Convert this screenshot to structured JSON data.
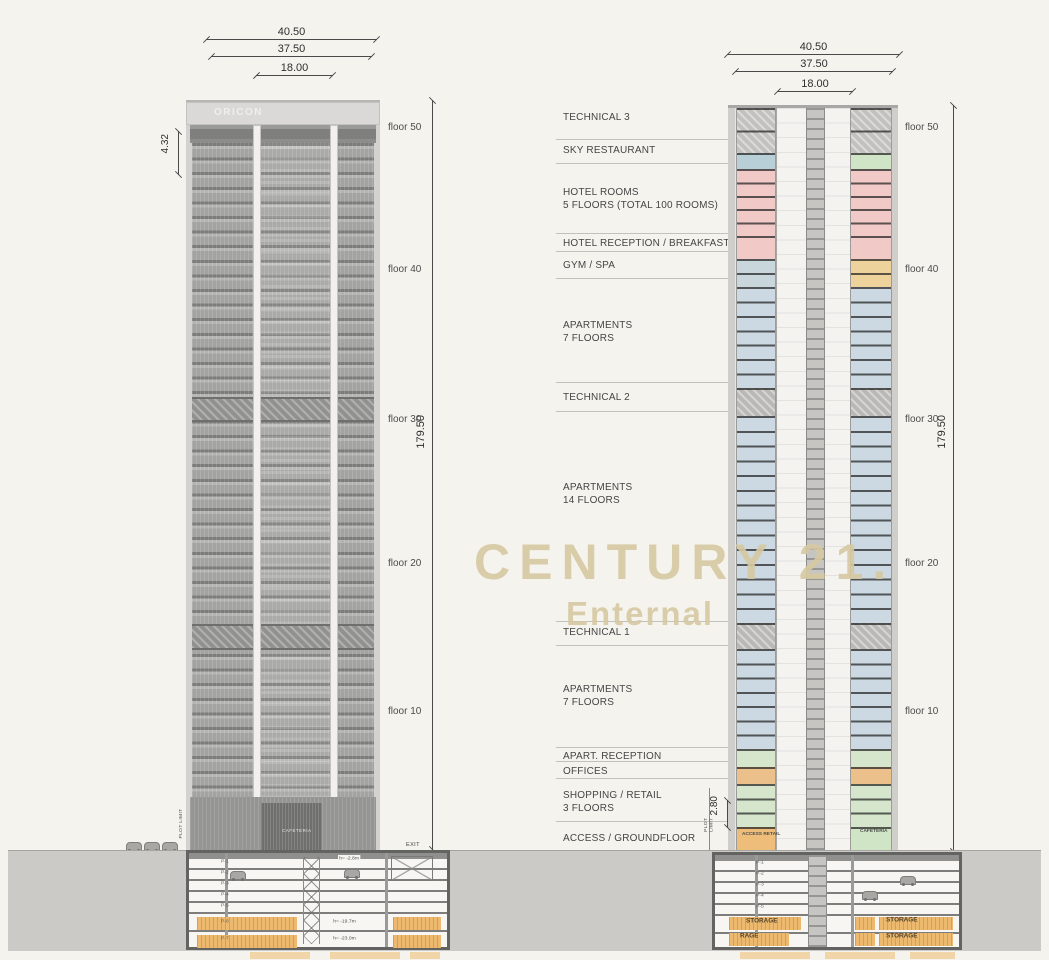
{
  "watermark": {
    "line1": "CENTURY 21.",
    "line2": "Enternal",
    "color": "#d7c9a2"
  },
  "program": [
    {
      "label": "TECHNICAL 3",
      "sub": ""
    },
    {
      "label": "SKY RESTAURANT",
      "sub": ""
    },
    {
      "label": "HOTEL ROOMS",
      "sub": "5 FLOORS (TOTAL 100 ROOMS)"
    },
    {
      "label": "HOTEL RECEPTION / BREAKFAST",
      "sub": ""
    },
    {
      "label": "GYM / SPA",
      "sub": ""
    },
    {
      "label": "APARTMENTS",
      "sub": "7 FLOORS"
    },
    {
      "label": "TECHNICAL 2",
      "sub": ""
    },
    {
      "label": "APARTMENTS",
      "sub": "14 FLOORS"
    },
    {
      "label": "TECHNICAL 1",
      "sub": ""
    },
    {
      "label": "APARTMENTS",
      "sub": "7 FLOORS"
    },
    {
      "label": "APART. RECEPTION",
      "sub": ""
    },
    {
      "label": "OFFICES",
      "sub": ""
    },
    {
      "label": "SHOPPING / RETAIL",
      "sub": "3 FLOORS"
    },
    {
      "label": "ACCESS / GROUNDFLOOR",
      "sub": ""
    },
    {
      "label": "PARKING",
      "sub": ""
    },
    {
      "label": "STORAGE",
      "sub": ""
    }
  ],
  "elevation": {
    "sign": "ORICON",
    "cafeteria_sign": "CAFETERIA",
    "dims_top": [
      "40.50",
      "37.50",
      "18.00"
    ],
    "dim_height": "179.50",
    "dim_crown": "4.32",
    "floor_labels": [
      "floor 50",
      "floor 40",
      "floor 30",
      "floor 20",
      "floor 10"
    ],
    "plot_limit": "PLOT LIMIT",
    "exit_label": "EXIT",
    "parking_levels": [
      "P-1",
      "P-2",
      "P-3",
      "P-4",
      "P-5",
      "P-6",
      "P-7"
    ],
    "level_heights": {
      "p1": "h= -2.8m",
      "p6": "h= -19.7m",
      "p7": "h= -23.0m"
    }
  },
  "section": {
    "dims_top": [
      "40.50",
      "37.50",
      "18.00"
    ],
    "dim_height": "179.50",
    "dim_retail": "2.80",
    "floor_labels": [
      "floor 50",
      "floor 40",
      "floor 30",
      "floor 20",
      "floor 10"
    ],
    "plot_limit": "PLOT LIMIT",
    "ground_floor": {
      "left": "ACCESS RETAIL",
      "right": "CAFETERIA"
    },
    "parking_levels": [
      "P-1",
      "P-2",
      "P-3",
      "P-4",
      "P-5",
      "P-6",
      "P-7"
    ],
    "storage_labels": [
      "STORAGE",
      "STORAGE",
      "RAGE",
      "STORAGE"
    ],
    "zones": [
      {
        "name": "technical-3",
        "height": 45,
        "floors": 2,
        "left": "#c2c1be",
        "right": "#c2c1be",
        "hatch": true
      },
      {
        "name": "sky-restaurant",
        "height": 16,
        "floors": 1,
        "left": "#b9cfd8",
        "right": "#cfe5c5",
        "hatch": false
      },
      {
        "name": "hotel-rooms",
        "height": 67,
        "floors": 5,
        "left": "#f1c9c7",
        "right": "#f1c9c7",
        "hatch": false
      },
      {
        "name": "hotel-reception",
        "height": 23,
        "floors": 1,
        "left": "#f1c9c7",
        "right": "#f1c9c7",
        "hatch": false
      },
      {
        "name": "gym-spa",
        "height": 28,
        "floors": 2,
        "left": "#c9d6dc",
        "right": "#eed29b",
        "hatch": false
      },
      {
        "name": "apartments-upper",
        "height": 101,
        "floors": 7,
        "left": "#ccd9e2",
        "right": "#ccd9e2",
        "hatch": false
      },
      {
        "name": "technical-2",
        "height": 28,
        "floors": 1,
        "left": "#b9b8b5",
        "right": "#b9b8b5",
        "hatch": true
      },
      {
        "name": "apartments-middle",
        "height": 207,
        "floors": 14,
        "left": "#ccd9e2",
        "right": "#ccd9e2",
        "hatch": false
      },
      {
        "name": "technical-1",
        "height": 26,
        "floors": 1,
        "left": "#b9b8b5",
        "right": "#b9b8b5",
        "hatch": true
      },
      {
        "name": "apartments-lower",
        "height": 100,
        "floors": 7,
        "left": "#ccd9e2",
        "right": "#ccd9e2",
        "hatch": false
      },
      {
        "name": "apart-reception",
        "height": 18,
        "floors": 1,
        "left": "#d5e6cc",
        "right": "#d5e6cc",
        "hatch": false
      },
      {
        "name": "offices",
        "height": 17,
        "floors": 1,
        "left": "#ecc08b",
        "right": "#ecc08b",
        "hatch": false
      },
      {
        "name": "shopping-retail",
        "height": 43,
        "floors": 3,
        "left": "#d5e6cc",
        "right": "#d5e6cc",
        "hatch": false
      },
      {
        "name": "access-groundfloor",
        "height": 28,
        "floors": 1,
        "left": "#eebd7a",
        "right": "#cfe5c5",
        "hatch": false
      }
    ]
  },
  "colors": {
    "background": "#f5f3ee",
    "ground": "#cbcac7",
    "hotel_pink": "#f1c9c7",
    "apartment_blue": "#ccd9e2",
    "green": "#d5e6cc",
    "storage_orange": "#ecb96f",
    "gym_yellow": "#eed29b",
    "technical_gray": "#b9b8b5",
    "watermark": "#d7c9a2"
  }
}
